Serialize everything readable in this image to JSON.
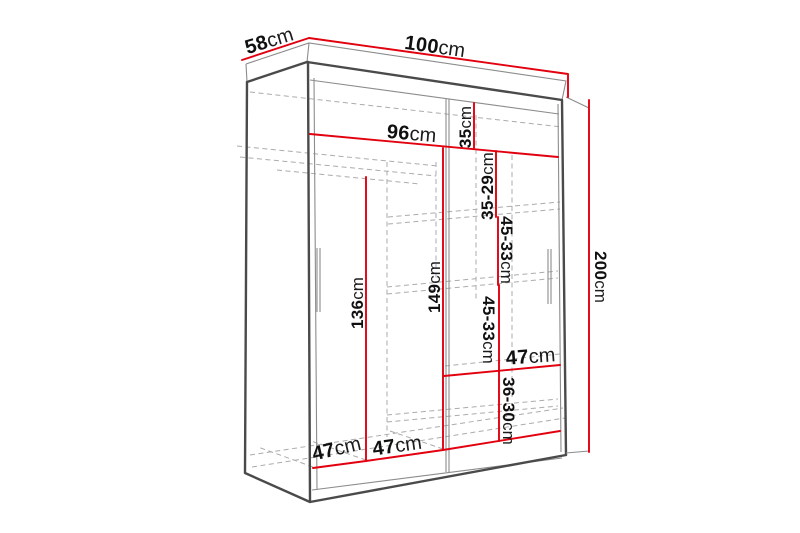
{
  "diagram": {
    "subject": "wardrobe-with-sliding-doors",
    "view": "front-perspective-dimension-drawing"
  },
  "colors": {
    "dimension_line": "#e2000f",
    "outline": "#4a4a4a",
    "secondary_line": "#8c8c8c",
    "hidden_line": "#ababab",
    "label_text": "#101010",
    "background": "#ffffff"
  },
  "dims": {
    "overall_width": {
      "value": "100",
      "unit": "cm"
    },
    "overall_depth": {
      "value": "58",
      "unit": "cm"
    },
    "overall_height": {
      "value": "200",
      "unit": "cm"
    },
    "interior_width": {
      "value": "96",
      "unit": "cm"
    },
    "top_shelf_height": {
      "value": "35",
      "unit": "cm"
    },
    "right_gap_1": {
      "value": "35-29",
      "unit": "cm"
    },
    "right_gap_2": {
      "value": "45-33",
      "unit": "cm"
    },
    "right_gap_3": {
      "value": "45-33",
      "unit": "cm"
    },
    "right_gap_4": {
      "value": "36-30",
      "unit": "cm"
    },
    "left_interior_height": {
      "value": "136",
      "unit": "cm"
    },
    "center_interior_height": {
      "value": "149",
      "unit": "cm"
    },
    "right_shelf_width": {
      "value": "47",
      "unit": "cm"
    },
    "bottom_left_width": {
      "value": "47",
      "unit": "cm"
    },
    "bottom_center_width": {
      "value": "47",
      "unit": "cm"
    }
  }
}
